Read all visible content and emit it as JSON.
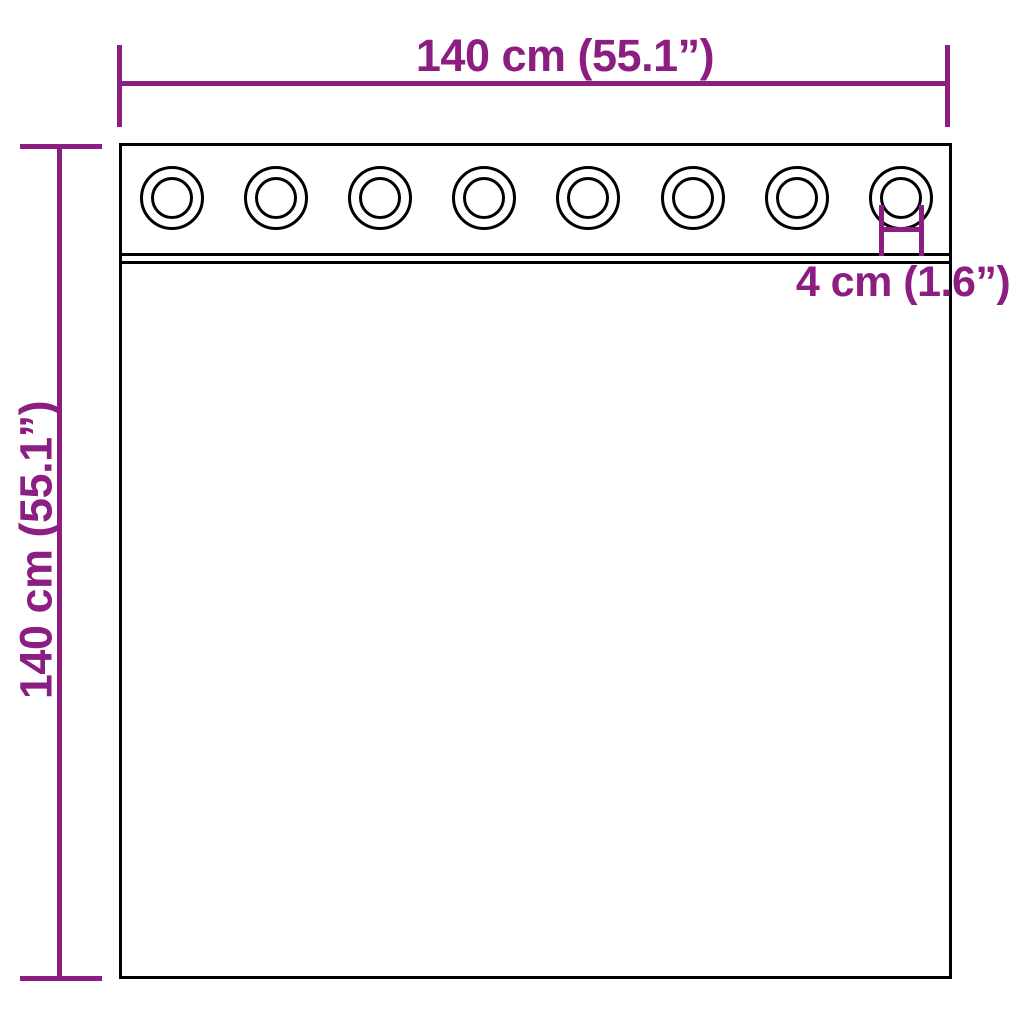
{
  "diagram": {
    "type": "curtain-with-grommets-dimension-diagram",
    "colors": {
      "dimension": "#8C1E82",
      "outline": "#000000",
      "background": "#ffffff"
    },
    "labels": {
      "width": "140 cm (55.1”)",
      "height": "140 cm (55.1”)",
      "grommet_diameter": "4 cm (1.6”)"
    },
    "grommet_count": 8
  }
}
